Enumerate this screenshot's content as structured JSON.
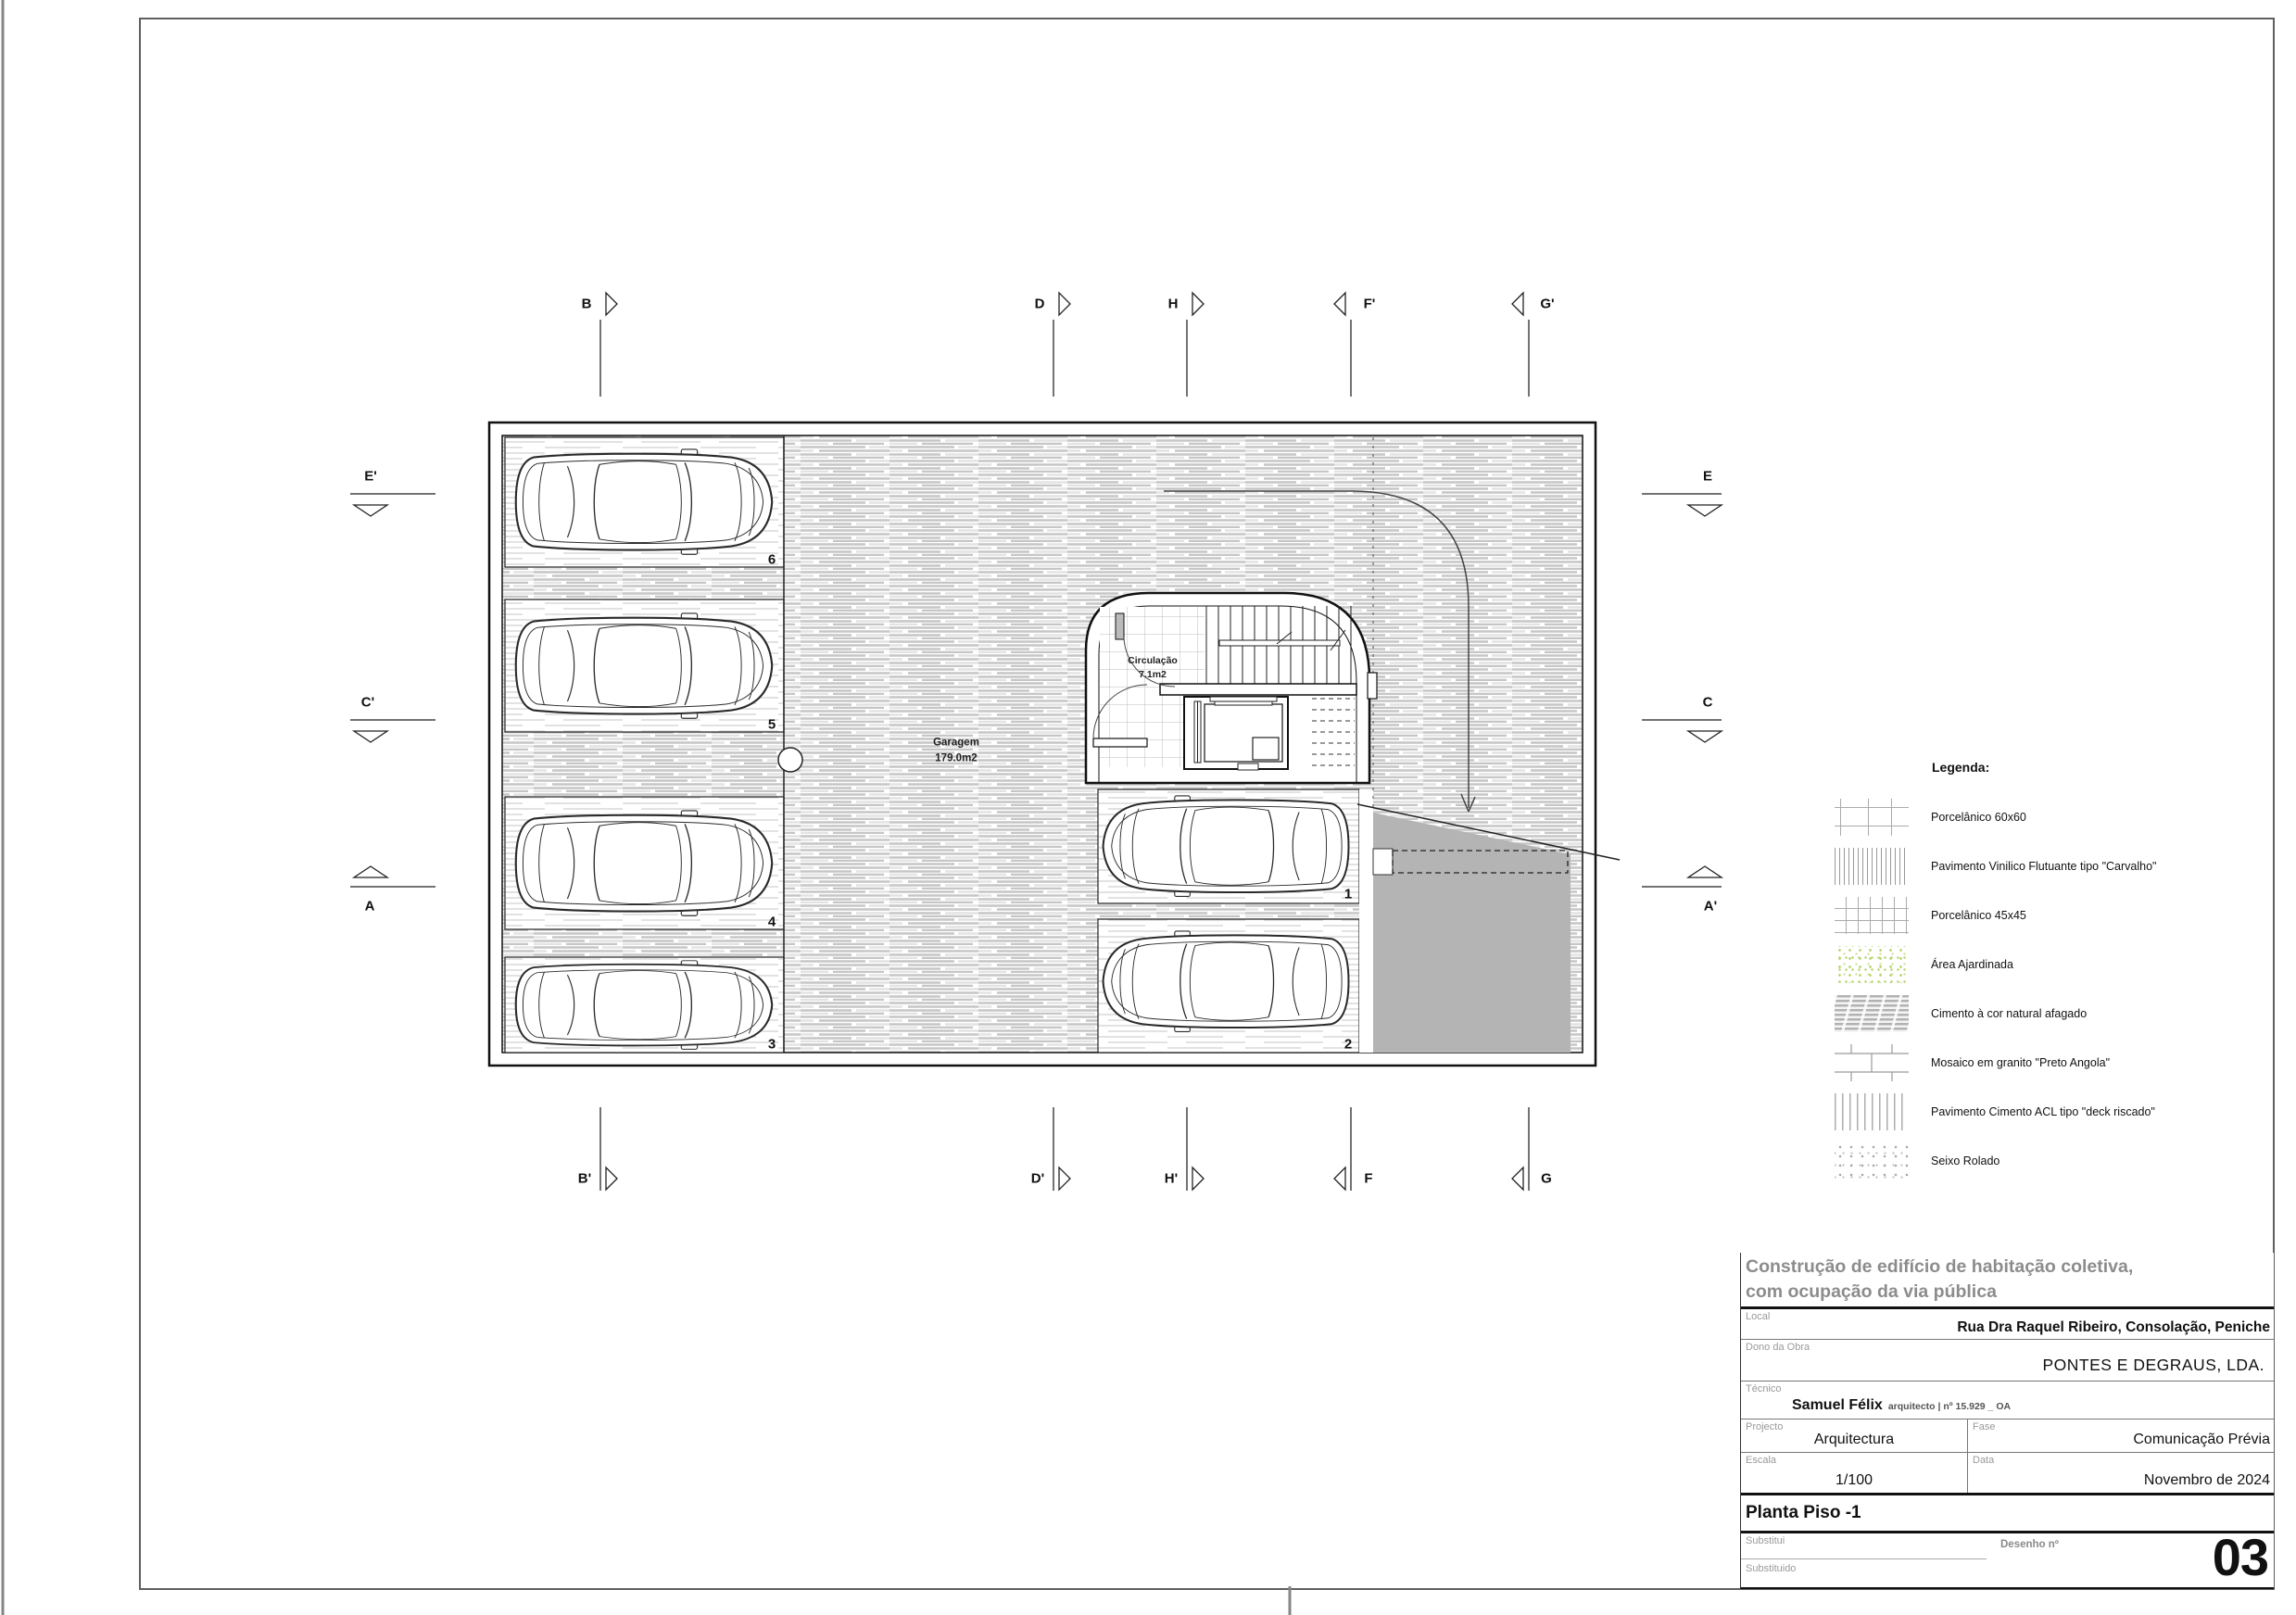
{
  "plan": {
    "garage": {
      "label": "Garagem",
      "area": "179.0m2"
    },
    "circulation": {
      "label": "Circulação",
      "area": "7.1m2"
    },
    "stalls": [
      {
        "number": "6"
      },
      {
        "number": "5"
      },
      {
        "number": "4"
      },
      {
        "number": "3"
      },
      {
        "number": "1"
      },
      {
        "number": "2"
      }
    ]
  },
  "markers": {
    "top": [
      {
        "label": "B"
      },
      {
        "label": "D"
      },
      {
        "label": "H"
      },
      {
        "label": "F'"
      },
      {
        "label": "G'"
      }
    ],
    "bottom": [
      {
        "label": "B'"
      },
      {
        "label": "D'"
      },
      {
        "label": "H'"
      },
      {
        "label": "F"
      },
      {
        "label": "G"
      }
    ],
    "left": [
      {
        "label": "E'"
      },
      {
        "label": "C'"
      },
      {
        "label": "A"
      }
    ],
    "right": [
      {
        "label": "E"
      },
      {
        "label": "C"
      },
      {
        "label": "A'"
      }
    ]
  },
  "legend": {
    "title": "Legenda:",
    "items": [
      {
        "label": "Porcelânico 60x60",
        "pattern": "porcelain-60x60"
      },
      {
        "label": "Pavimento Vinilico Flutuante tipo \"Carvalho\"",
        "pattern": "vinyl-plank"
      },
      {
        "label": "Porcelânico 45x45",
        "pattern": "porcelain-45x45"
      },
      {
        "label": "Área Ajardinada",
        "pattern": "garden-dots"
      },
      {
        "label": "Cimento à cor natural afagado",
        "pattern": "smoothed-cement"
      },
      {
        "label": "Mosaico em granito \"Preto Angola\"",
        "pattern": "granite-mosaic"
      },
      {
        "label": "Pavimento Cimento ACL tipo \"deck riscado\"",
        "pattern": "scored-deck"
      },
      {
        "label": "Seixo Rolado",
        "pattern": "pebbles"
      }
    ]
  },
  "title_block": {
    "project_title_line1": "Construção de edifício de habitação coletiva,",
    "project_title_line2": "com ocupação da via pública",
    "local_label": "Local",
    "local_value": "Rua Dra Raquel Ribeiro, Consolação, Peniche",
    "owner_label": "Dono da Obra",
    "owner_value": "PONTES E DEGRAUS, LDA.",
    "technician_label": "Técnico",
    "technician_name": "Samuel Félix",
    "technician_credentials": "arquitecto | nº 15.929 _ OA",
    "project_label": "Projecto",
    "project_value": "Arquitectura",
    "phase_label": "Fase",
    "phase_value": "Comunicação Prévia",
    "scale_label": "Escala",
    "scale_value": "1/100",
    "date_label": "Data",
    "date_value": "Novembro de 2024",
    "drawing_title": "Planta Piso -1",
    "replaces_label": "Substitui",
    "replaced_label": "Substituido",
    "drawing_number_label": "Desenho nº",
    "drawing_number": "03"
  },
  "colors": {
    "ramp_gray": "#b4b4b4",
    "hatch_gray": "#c6c6c6",
    "garden_green": "#b9d673",
    "title_gray": "#8c8c8c"
  }
}
